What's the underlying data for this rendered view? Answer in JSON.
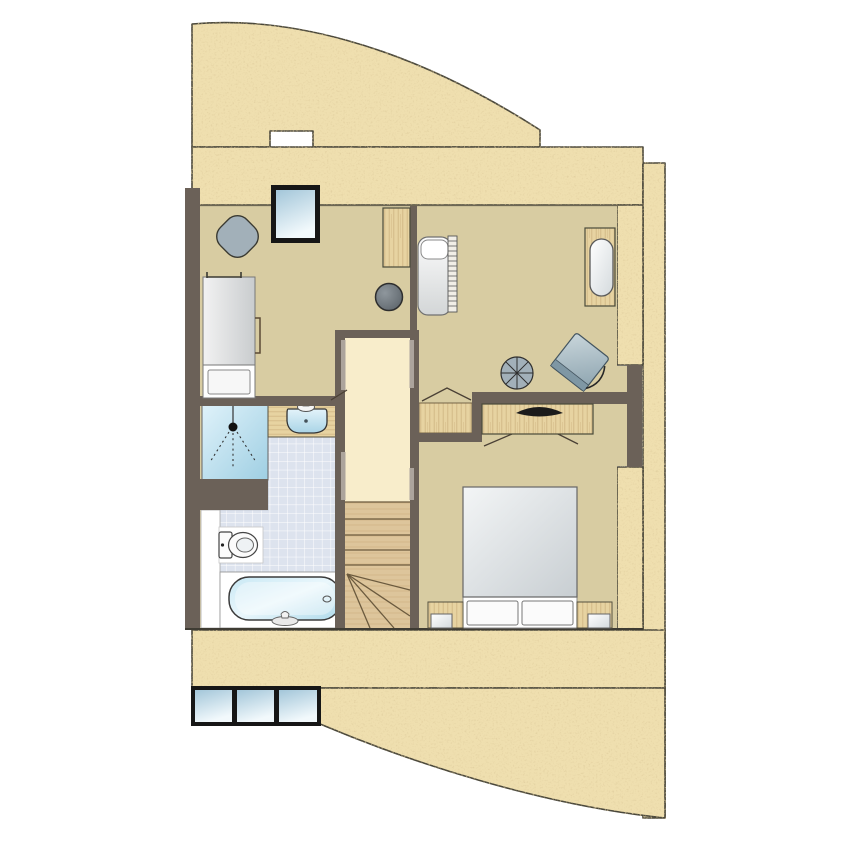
{
  "scene": {
    "kind": "architectural-floor-plan",
    "storey": "upper-level",
    "orientation": "top-down"
  },
  "colors": {
    "sand": "#EFDFAF",
    "sand-line": "#4A473A",
    "wall": "#6B6158",
    "wall-jamb": "#ACA49C",
    "tan": "#D8CCA2",
    "cream": "#F8EDCB",
    "wood-light": "#E7D3A1",
    "wood-grain": "#C2A571",
    "stair-wood": "#DDC59B",
    "stair-line": "#6B5A3E",
    "tile": "#DDE3EE",
    "tile-line": "#FFFFFF",
    "fixture-blue-light": "#D2EBF6",
    "fixture-blue-deep": "#9FCFE3",
    "furniture-grey": "#A2B0B9",
    "stool-grey": "#6E767C",
    "frame-black": "#161616",
    "ink": "#3F3C33",
    "white": "#FFFFFF"
  },
  "rooms": [
    {
      "name": "bedroom-left",
      "floor": "tan"
    },
    {
      "name": "bedroom-right",
      "floor": "tan"
    },
    {
      "name": "master-bedroom",
      "floor": "tan"
    },
    {
      "name": "stair-hall",
      "floor": "cream"
    },
    {
      "name": "bathroom",
      "floor": "tiles"
    }
  ],
  "elements": [
    "roof-terrace-surface",
    "skylight-window",
    "bottom-window-row",
    "diamond-table",
    "single-bed",
    "wall-bracket",
    "wardrobe-shelf",
    "stool",
    "lounge-chair",
    "radiator",
    "cot-lounger",
    "round-table",
    "armchair",
    "tv-dresser",
    "double-bed",
    "nightstand-left",
    "nightstand-right",
    "shower",
    "washbasin-counter",
    "toilet",
    "bathtub",
    "staircase",
    "landing"
  ],
  "window_counts": {
    "top_skylight_panes": 1,
    "bottom_row_panes": 3
  }
}
